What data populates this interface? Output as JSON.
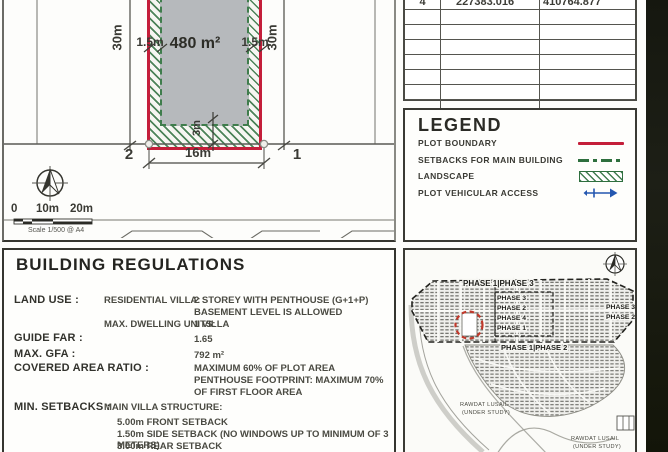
{
  "drawing": {
    "area": "480 m²",
    "width_dim": "16m",
    "height_dim_left": "30m",
    "height_dim_right": "30m",
    "side_setback_left": "1.5m",
    "side_setback_right": "1.5m",
    "rear_setback": "3m",
    "corner_left": "2",
    "corner_right": "1",
    "scale_0": "0",
    "scale_10": "10m",
    "scale_20": "20m",
    "scale_caption": "Scale 1/500 @ A4"
  },
  "coordinates_table": {
    "row": {
      "point": "4",
      "x": "227383.016",
      "y": "410764.877"
    }
  },
  "legend": {
    "title": "LEGEND",
    "items": [
      {
        "label": "PLOT BOUNDARY",
        "symbol": "red-solid-line"
      },
      {
        "label": "SETBACKS FOR MAIN BUILDING",
        "symbol": "green-dashed-line"
      },
      {
        "label": "LANDSCAPE",
        "symbol": "green-hatch-swatch"
      },
      {
        "label": "PLOT VEHICULAR ACCESS",
        "symbol": "blue-double-arrow"
      }
    ],
    "colors": {
      "boundary": "#c41e3a",
      "setback": "#2e6f3e",
      "landscape": "#2e6f3e",
      "access": "#2457b0"
    }
  },
  "regulations": {
    "title": "BUILDING REGULATIONS",
    "land_use_label": "LAND USE :",
    "land_use_key1": "RESIDENTIAL VILLA:",
    "land_use_val1a": "2 STOREY WITH PENTHOUSE  (G+1+P)",
    "land_use_val1b": "BASEMENT LEVEL IS ALLOWED",
    "land_use_key2": "MAX. DWELLING UNITS:",
    "land_use_val2": "1 VILLA",
    "guide_far_label": "GUIDE FAR :",
    "guide_far_value": "1.65",
    "max_gfa_label": "MAX. GFA :",
    "max_gfa_value": "792 m²",
    "covered_label": "COVERED AREA RATIO :",
    "covered_val1": "MAXIMUM 60% OF PLOT AREA",
    "covered_val2": "PENTHOUSE FOOTPRINT: MAXIMUM 70% OF FIRST FLOOR AREA",
    "setbacks_label": "MIN. SETBACKS :",
    "setbacks_key": "MAIN VILLA STRUCTURE:",
    "setbacks_items": [
      "5.00m FRONT SETBACK",
      "1.50m SIDE SETBACK (NO WINDOWS UP TO MINIMUM OF 3 METERS)",
      "3.00m REAR SETBACK"
    ]
  },
  "siteplan": {
    "top_label": "PHASE 1|PHASE 3",
    "stack_labels": [
      "PHASE 3",
      "PHASE 2",
      "PHASE 4",
      "PHASE 1"
    ],
    "right_labels": [
      "PHASE 3",
      "PHASE 2"
    ],
    "mid_label": "PHASE 1|PHASE 2",
    "area_note_1_line1": "RAWDAT LUSAIL",
    "area_note_1_line2": "(UNDER STUDY)",
    "area_note_2_line1": "RAWDAT LUSAIL",
    "area_note_2_line2": "(UNDER STUDY)"
  }
}
